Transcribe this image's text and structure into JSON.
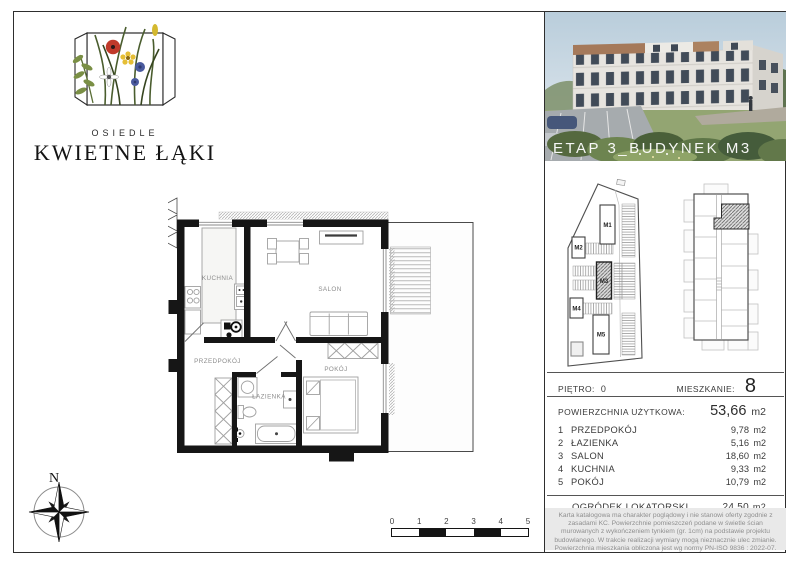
{
  "logo": {
    "estate_label": "OSIEDLE",
    "estate_name": "KWIETNE ŁĄKI"
  },
  "colors": {
    "poppy": "#c03a2b",
    "cornflower": "#4a5a9e"
  },
  "photo": {
    "caption": "ETAP 3_BUDYNEK M3"
  },
  "site_plan": {
    "highlighted_building": "M3",
    "labels": {
      "m1": "M1",
      "m2": "M2",
      "m3": "M3",
      "m4": "M4",
      "m5": "M5"
    }
  },
  "floor_plan": {
    "labels": {
      "kuchnia": "KUCHNIA",
      "salon": "SALON",
      "przedpokoj": "PRZEDPOKÓJ",
      "pokoj": "POKÓJ",
      "lazienka": "ŁAZIENKA"
    }
  },
  "compass": {
    "north_label": "N"
  },
  "scale_bar": {
    "ticks": [
      "0",
      "1",
      "2",
      "3",
      "4",
      "5"
    ]
  },
  "info": {
    "floor_label": "PIĘTRO:",
    "floor_value": "0",
    "apartment_label": "MIESZKANIE:",
    "apartment_value": "8",
    "area_label": "POWIERZCHNIA UŻYTKOWA:",
    "area_value": "53,66",
    "area_unit": "m2",
    "rooms": [
      {
        "no": "1",
        "name": "PRZEDPOKÓJ",
        "area": "9,78",
        "unit": "m2"
      },
      {
        "no": "2",
        "name": "ŁAZIENKA",
        "area": "5,16",
        "unit": "m2"
      },
      {
        "no": "3",
        "name": "SALON",
        "area": "18,60",
        "unit": "m2"
      },
      {
        "no": "4",
        "name": "KUCHNIA",
        "area": "9,33",
        "unit": "m2"
      },
      {
        "no": "5",
        "name": "POKÓJ",
        "area": "10,79",
        "unit": "m2"
      }
    ],
    "garden_label": "OGRÓDEK LOKATORSKI",
    "garden_value": "24,50",
    "garden_unit": "m2"
  },
  "disclaimer": {
    "text": "Karta katalogowa ma charakter poglądowy i nie stanowi oferty zgodnie z zasadami KC. Powierzchnie pomieszczeń podane w świetle ścian murowanych z wykończeniem tynkiem (gr. 1cm) na podstawie projektu budowlanego. W trakcie realizacji wymiary mogą nieznacznie ulec zmianie. Powierzchnia mieszkania obliczona jest wg normy PN-ISO 9836 : 2022-07."
  }
}
